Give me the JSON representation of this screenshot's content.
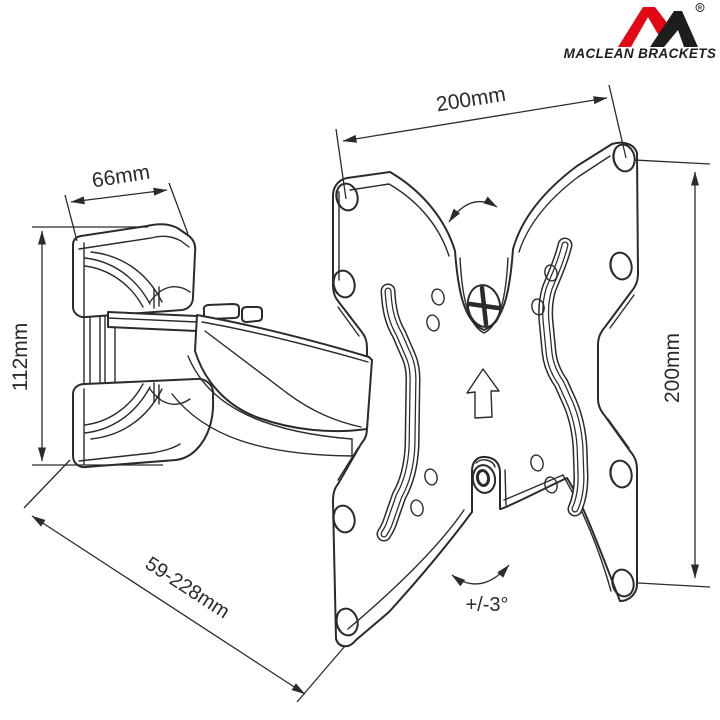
{
  "document": {
    "background": "#ffffff",
    "line_color": "#2b2b2b",
    "subject": "articulating TV wall-mount bracket with VESA plate, technical line drawing"
  },
  "logo": {
    "brand_text": "MACLEAN BRACKETS",
    "registered_mark": "R",
    "red": "#e30613",
    "dark": "#1d1d1b"
  },
  "dimensions": {
    "plate_width": "200mm",
    "plate_height": "200mm",
    "bracket_depth": "66mm",
    "bracket_height": "112mm",
    "extension_range": "59-228mm",
    "tilt_angle": "+/-3°"
  }
}
